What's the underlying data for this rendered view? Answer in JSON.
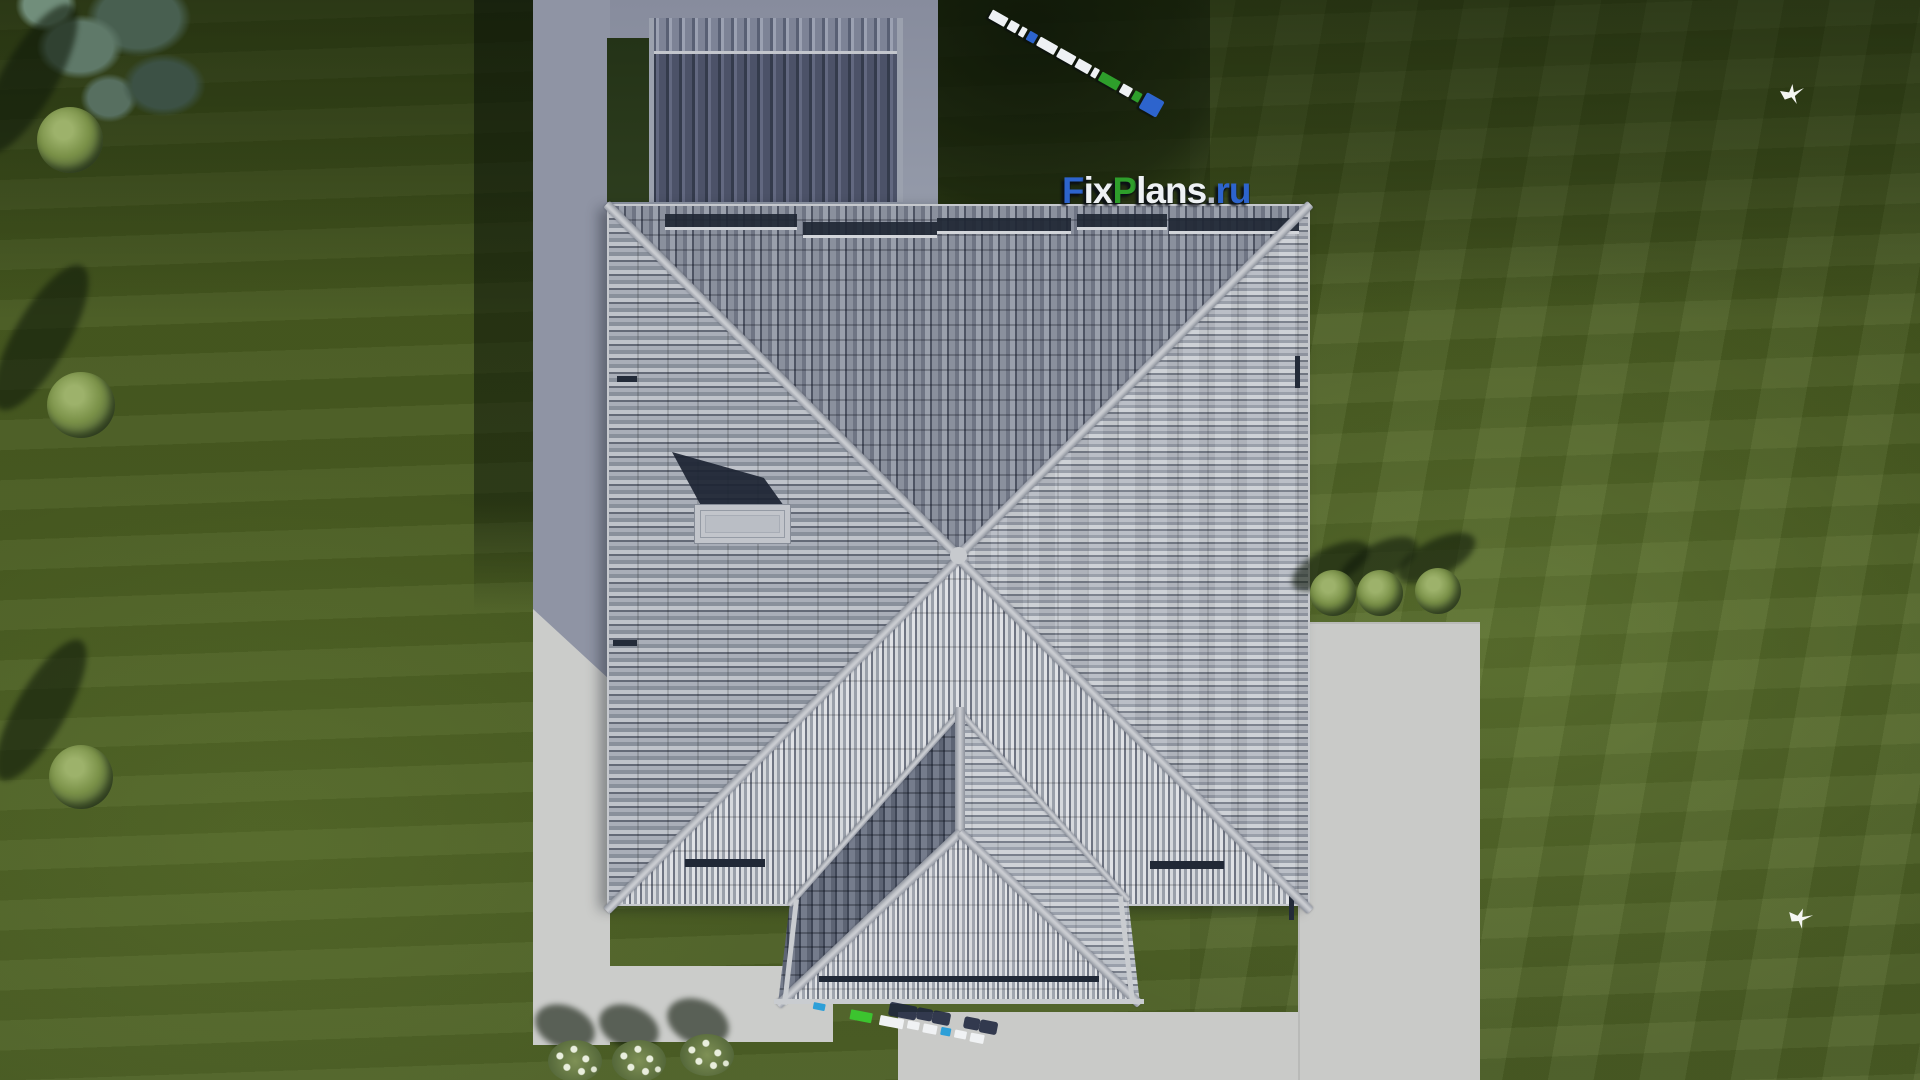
{
  "scene": {
    "title": "Aerial top-down 3D render of a hip-roof house plan",
    "watermark": {
      "text": "FixPlans.ru",
      "segments": {
        "f": "F",
        "ix": "ix",
        "p": "P",
        "lans": "lans",
        "dot": ".",
        "ru": "ru"
      },
      "colors": {
        "blue": "#2d64cd",
        "green": "#2e9e2b",
        "white": "#eef1f4"
      }
    },
    "palette": {
      "grass": "#47591f",
      "grass_dark": "#1f2c12",
      "grass_light": "#5b7034",
      "roof_tile_light": "#b6bac2",
      "roof_tile_dark": "#6b717e",
      "roof_ridge": "#c6c9ce",
      "rear_roof": "#535969",
      "paving_sunlit": "#c9cac8",
      "paving_shadow": "#8f94a4",
      "chimney": "#c0c3c9",
      "snow_guard": "#1f2734"
    },
    "objects": {
      "main_roof": "square hip roof with central apex and X ridges",
      "porch_roof": "front porch hip roof with Y ridge",
      "rear_roof": "rear wing shed roof in shadow",
      "chimney": "chimney on west slope",
      "driveway": "concrete driveway, bottom right",
      "walkway": "L-shaped concrete path, left",
      "bush_count_left": 3,
      "bush_count_right": 3,
      "flower_bush_count": 3,
      "bird_count": 2,
      "tree_count": 1
    }
  }
}
